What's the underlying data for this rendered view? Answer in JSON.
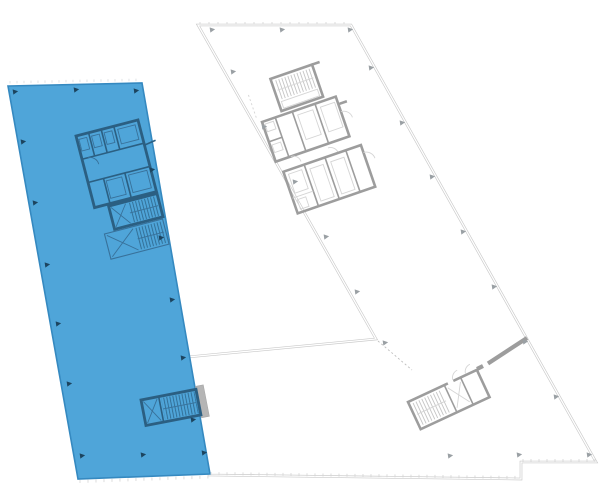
{
  "meta": {
    "title": "Building floor plan selector",
    "canvas_width": 600,
    "canvas_height": 500,
    "selected_floor": "left-wing",
    "floor_count_visible": 2
  },
  "colors": {
    "background": "#ffffff",
    "blue_fill": "#4fa5d9",
    "blue_edge": "#3589c0",
    "blue_core": "#2b5f82",
    "blue_core_light": "#38719a",
    "blue_marker": "#1c445f",
    "gray_outline": "#c9c9c9",
    "gray_wall": "#9d9d9d",
    "gray_wall_light": "#d5d5d5",
    "gray_hatch": "#bcbcbc",
    "gray_marker": "#9aa0a4",
    "gray_bar": "#b5b5b5",
    "tick_gray": "#d4d4d4",
    "tick_light": "#d9dcdf",
    "dash_gray": "#bdbdbd"
  },
  "floors": {
    "selected": {
      "id": "left-wing",
      "state": "selected",
      "points": "8,86 142,83 210,474 78,479"
    },
    "adjacent": {
      "id": "right-wing",
      "state": "default",
      "points": "198,25 351,25 596,462 521,462 521,479 209,475 188,357 376,339"
    }
  },
  "annotations": {
    "markers_selected": [
      [
        13,
        92
      ],
      [
        74,
        90
      ],
      [
        134,
        91
      ],
      [
        21,
        142
      ],
      [
        33,
        203
      ],
      [
        45,
        265
      ],
      [
        56,
        324
      ],
      [
        67,
        384
      ],
      [
        80,
        456
      ],
      [
        141,
        455
      ],
      [
        202,
        453
      ],
      [
        150,
        170
      ],
      [
        159,
        238
      ],
      [
        170,
        300
      ],
      [
        181,
        358
      ],
      [
        191,
        420
      ]
    ],
    "markers_adjacent": [
      [
        210,
        30
      ],
      [
        280,
        30
      ],
      [
        348,
        30
      ],
      [
        231,
        72
      ],
      [
        262,
        127
      ],
      [
        293,
        182
      ],
      [
        324,
        237
      ],
      [
        355,
        292
      ],
      [
        369,
        68
      ],
      [
        400,
        123
      ],
      [
        430,
        177
      ],
      [
        461,
        232
      ],
      [
        492,
        287
      ],
      [
        523,
        342
      ],
      [
        554,
        397
      ],
      [
        448,
        456
      ],
      [
        517,
        455
      ],
      [
        587,
        455
      ],
      [
        383,
        343
      ]
    ],
    "ticks": [
      {
        "x1": 10,
        "y1": 83.5,
        "x2": 141,
        "y2": 81,
        "step": 7,
        "len": -2.5,
        "color": "tick_light"
      },
      {
        "x1": 80,
        "y1": 480,
        "x2": 209,
        "y2": 475.5,
        "step": 8,
        "len": 3,
        "color": "tick_gray"
      },
      {
        "x1": 211,
        "y1": 475,
        "x2": 520,
        "y2": 479,
        "step": 8,
        "len": -3,
        "color": "tick_gray"
      },
      {
        "x1": 523,
        "y1": 462,
        "x2": 595,
        "y2": 462,
        "step": 8,
        "len": -3,
        "color": "tick_gray"
      },
      {
        "x1": 200,
        "y1": 24.5,
        "x2": 350,
        "y2": 24.5,
        "step": 9,
        "len": -2.5,
        "color": "tick_gray"
      }
    ],
    "dashed_link": {
      "x1": 378,
      "y1": 341,
      "x2": 412,
      "y2": 370
    }
  }
}
